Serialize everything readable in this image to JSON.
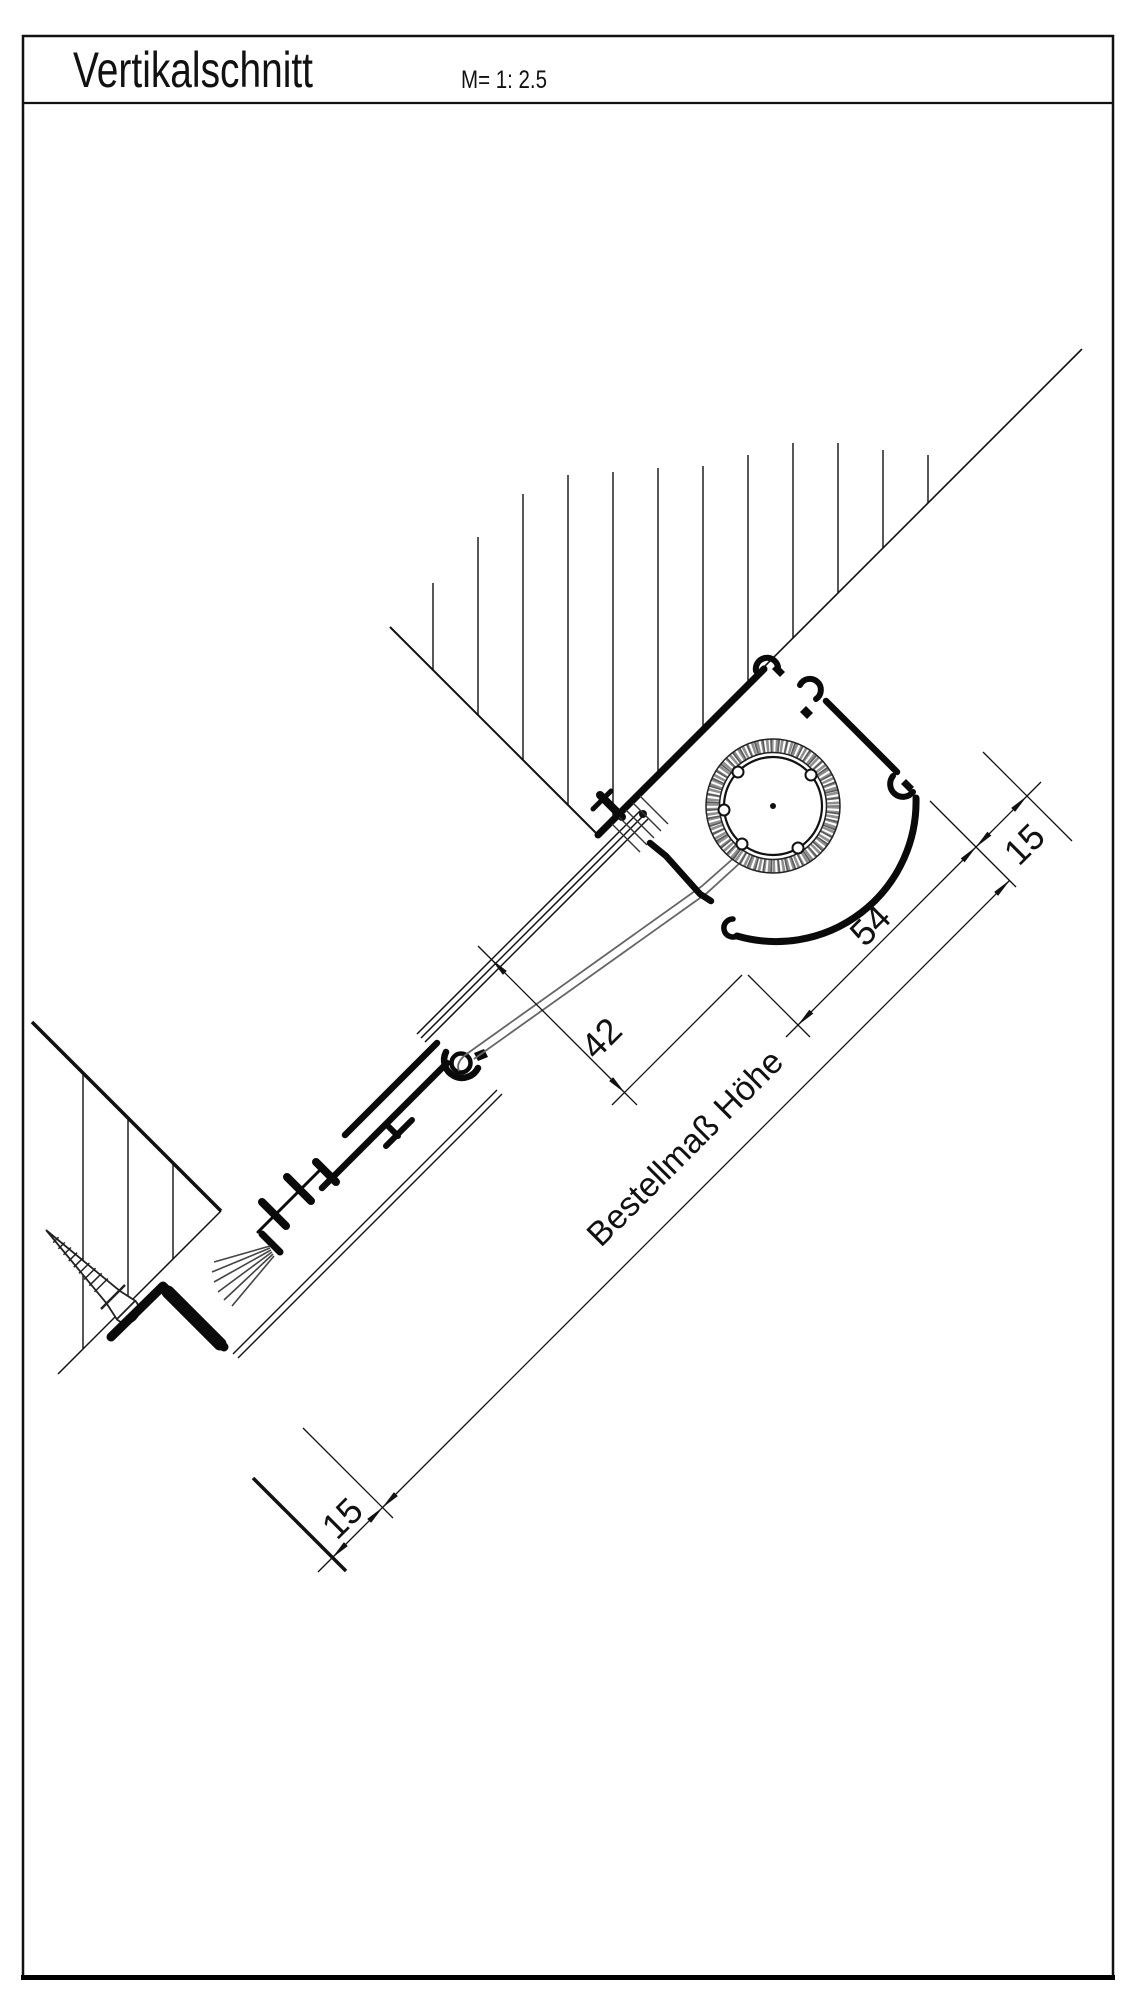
{
  "sheet": {
    "title": "Vertikalschnitt",
    "scale_label": "M= 1: 2.5"
  },
  "dimensions": {
    "top_offset": "15",
    "housing_depth": "54",
    "glass_clearance": "42",
    "bottom_offset": "15",
    "order_height_label": "Bestellmaß Höhe"
  },
  "colors": {
    "line": "#111111",
    "coil_stipple": "#8f8f8f",
    "brush": "#444444",
    "fabric": "#666666"
  }
}
